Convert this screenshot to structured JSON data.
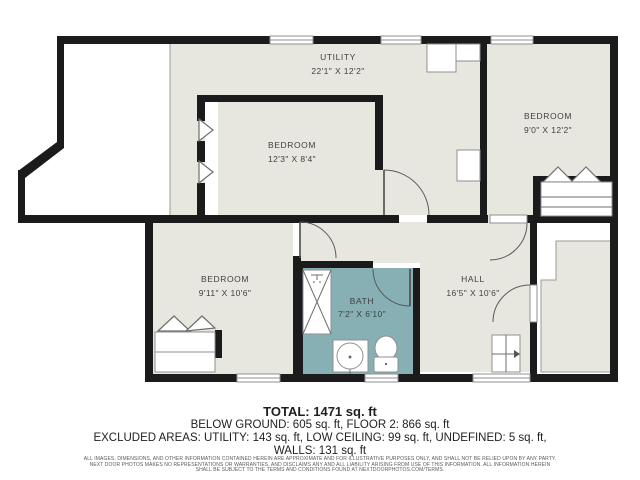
{
  "plan_title": "floor-plan",
  "colors": {
    "room_fill": "#e8e7df",
    "bath_fill": "#87b0b4",
    "wall": "#1b1b1b",
    "label_text": "#3f3f3f"
  },
  "rooms": {
    "utility": {
      "name": "UTILITY",
      "dims": "22'1\" X 12'2\""
    },
    "bedroom_top": {
      "name": "BEDROOM",
      "dims": "12'3\" X 8'4\""
    },
    "bedroom_right": {
      "name": "BEDROOM",
      "dims": "9'0\" X 12'2\""
    },
    "bedroom_lower": {
      "name": "BEDROOM",
      "dims": "9'11\" X 10'6\""
    },
    "bath": {
      "name": "BATH",
      "dims": "7'2\" X 6'10\""
    },
    "hall": {
      "name": "HALL",
      "dims": "16'5\" X 10'6\""
    }
  },
  "summary": {
    "total": "TOTAL: 1471 sq. ft",
    "breakdown": "BELOW GROUND: 605 sq. ft, FLOOR 2: 866 sq. ft",
    "excluded": "EXCLUDED AREAS: UTILITY: 143 sq. ft, LOW CEILING: 99 sq. ft, UNDEFINED: 5 sq. ft,",
    "walls": "WALLS: 131 sq. ft"
  },
  "disclaimer": {
    "line1": "ALL IMAGES, DIMENSIONS, AND OTHER INFORMATION CONTAINED HEREIN ARE APPROXIMATE AND FOR ILLUSTRATIVE PURPOSES ONLY, AND SHALL NOT BE RELIED UPON BY ANY PARTY.",
    "line2": "NEXT DOOR PHOTOS MAKES NO REPRESENTATIONS OR WARRANTIES, AND DISCLAIMS ANY AND ALL LIABILITY ARISING FROM USE OF THIS INFORMATION. ALL INFORMATION HEREIN",
    "line3": "SHALL BE SUBJECT TO THE TERMS AND CONDITIONS FOUND AT NEXTDOORPHOTOS.COM/TERMS."
  }
}
